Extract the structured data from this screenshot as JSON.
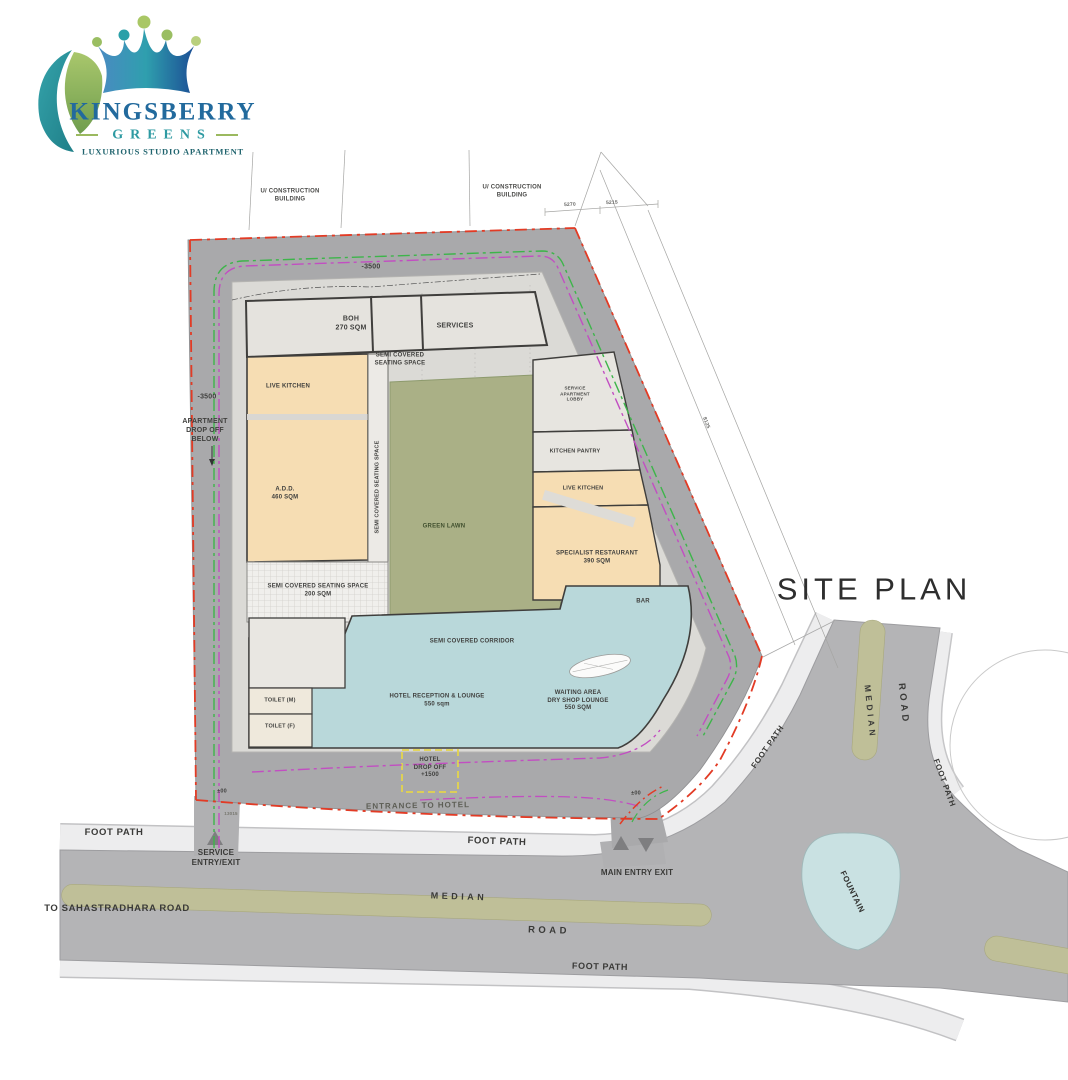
{
  "logo": {
    "name": "KINGSBERRY",
    "sub": "GREENS",
    "tagline": "LUXURIOUS STUDIO APARTMENT"
  },
  "title": "SITE PLAN",
  "context": {
    "construction_nw": "U/ CONSTRUCTION\nBUILDING",
    "construction_ne": "U/ CONSTRUCTION\nBUILDING",
    "dim_5270": "5270",
    "dim_5215": "5215",
    "dim_8125": "8125",
    "dim_13015": "13015",
    "level_top": "-3500",
    "level_left": "-3500",
    "level_zero_left": "±00",
    "level_zero_right": "±00",
    "apartment_drop_off": "APARTMENT\nDROP OFF\nBELOW"
  },
  "rooms": {
    "boh": "BOH\n270 SQM",
    "services": "SERVICES",
    "semi_covered_seating_top": "SEMI COVERED\nSEATING SPACE",
    "live_kitchen_left": "LIVE KITCHEN",
    "add": "A.D.D.\n460 SQM",
    "seating_strip": "SEMI COVERED SEATING SPACE",
    "green_lawn": "GREEN LAWN",
    "service_apartment_lobby": "SERVICE\nAPARTMENT\nLOBBY",
    "kitchen_pantry": "KITCHEN PANTRY",
    "live_kitchen_right": "LIVE KITCHEN",
    "specialist_restaurant": "SPECIALIST RESTAURANT\n390 SQM",
    "bar": "BAR",
    "seating_200": "SEMI COVERED SEATING SPACE\n200 SQM",
    "semi_covered_corridor": "SEMI COVERED CORRIDOR",
    "toilet_m": "TOILET (M)",
    "toilet_f": "TOILET (F)",
    "reception": "HOTEL RECEPTION & LOUNGE\n550 sqm",
    "waiting": "WAITING AREA\nDRY SHOP LOUNGE\n550 SQM"
  },
  "site": {
    "hotel_drop_off": "HOTEL\nDROP OFF\n+1500",
    "entrance_to_hotel": "ENTRANCE TO HOTEL",
    "service_entry": "SERVICE\nENTRY/EXIT",
    "main_entry": "MAIN ENTRY EXIT",
    "footpath_left": "FOOT PATH",
    "footpath_center": "FOOT PATH",
    "footpath_bottom": "FOOT PATH",
    "footpath_right_upper": "FOOT PATH",
    "footpath_right_lower": "FOOT PATH",
    "median_bottom": "MEDIAN",
    "median_right": "MEDIAN",
    "road_bottom": "ROAD",
    "road_right": "ROAD",
    "to_road": "TO SAHASTRADHARA ROAD",
    "fountain": "FOUNTAIN"
  },
  "colors": {
    "boundary_red": "#e23b25",
    "lane_magenta": "#c24ec2",
    "lane_green": "#3db54a",
    "drop_off_yellow": "#e3d44c",
    "room_peach": "#f6ddb3",
    "lounge_blue": "#b9d8da",
    "lawn_green": "#aab086",
    "road_gray": "#a9a9ab",
    "median_olive": "#bfbf98",
    "fountain_blue": "#c9e1e2",
    "logo_blue": "#2a6a9a",
    "logo_teal": "#2d9aa2",
    "logo_green": "#9bb95f"
  }
}
